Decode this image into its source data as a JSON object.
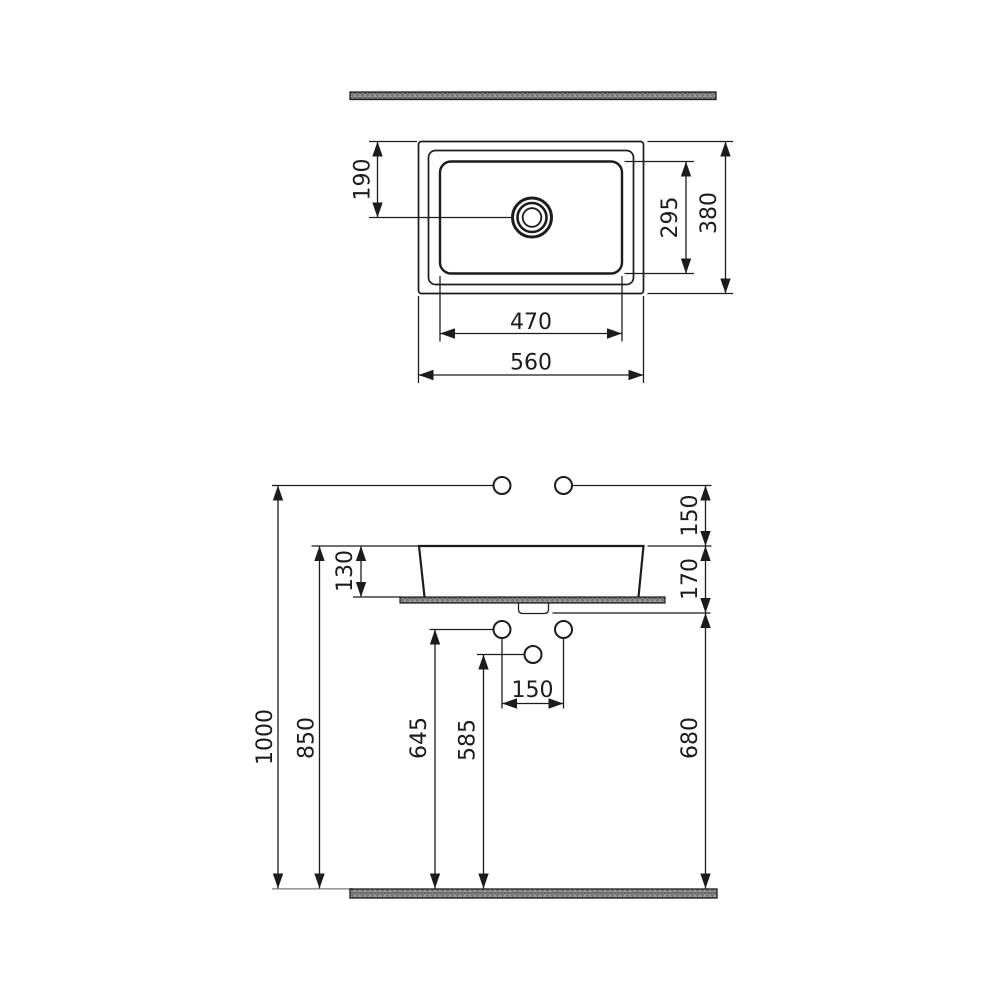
{
  "drawing": {
    "kind": "washbasin installation technical drawing",
    "views": {
      "plan": {
        "dimensions": {
          "drain_center_from_back_edge": "190",
          "bowl_inner_depth": "295",
          "overall_depth": "380",
          "bowl_inner_width": "470",
          "overall_width": "560"
        }
      },
      "front": {
        "dimensions": {
          "supply_above_rim": "150",
          "basin_height_above_counter": "130",
          "rim_to_waste_outlet": "170",
          "supply_height_from_floor": "1000",
          "rim_height_from_floor": "850",
          "angle_valve_height": "645",
          "waste_pipe_height": "585",
          "angle_valve_spacing": "150",
          "waste_outlet_height": "680"
        }
      }
    },
    "colors": {
      "line": "#1c1c1c",
      "hatch_fill": "#ababab",
      "hatch_stroke": "#5e5e5e",
      "floor_line": "#9a9a9a",
      "background": "#ffffff"
    }
  }
}
